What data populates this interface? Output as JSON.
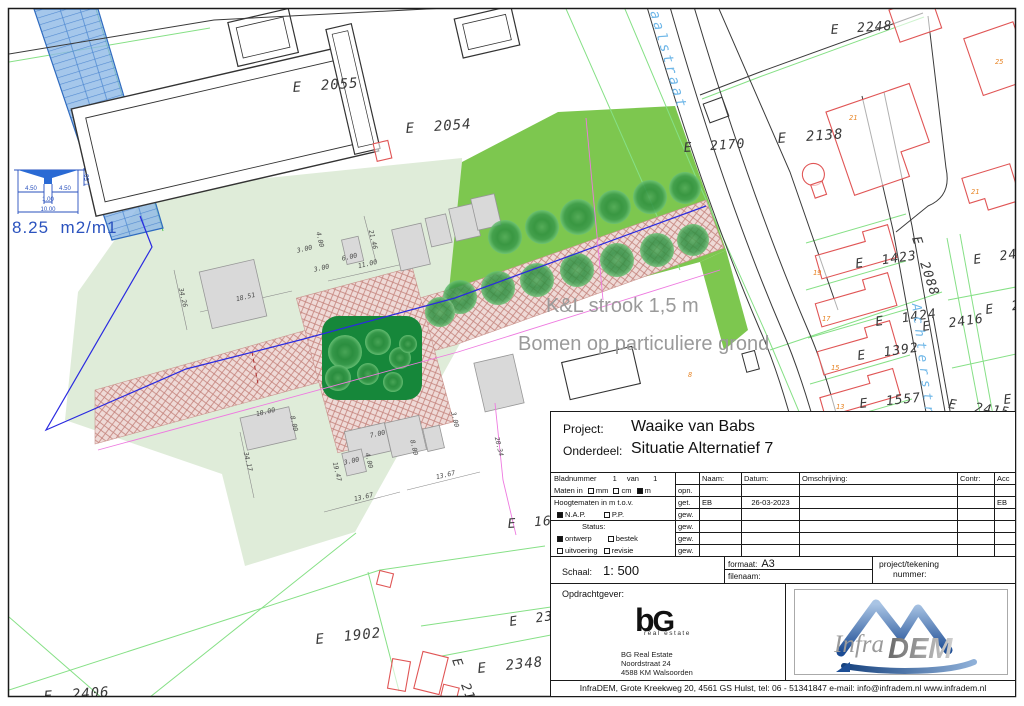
{
  "map": {
    "parcel_labels": [
      {
        "text": "E  2055",
        "x": 293,
        "y": 92,
        "size": 14,
        "rot": -4
      },
      {
        "text": "E  2054",
        "x": 406,
        "y": 133,
        "size": 14,
        "rot": -4
      },
      {
        "text": "E  2170",
        "x": 684,
        "y": 152,
        "size": 13,
        "rot": -4
      },
      {
        "text": "E  2138",
        "x": 778,
        "y": 143,
        "size": 14,
        "rot": -4
      },
      {
        "text": "E  2248",
        "x": 831,
        "y": 34,
        "size": 13,
        "rot": -4
      },
      {
        "text": "E  1423",
        "x": 856,
        "y": 268,
        "size": 13,
        "rot": -8
      },
      {
        "text": "E  2088",
        "x": 912,
        "y": 238,
        "size": 13,
        "rot": 72
      },
      {
        "text": "E  2417",
        "x": 974,
        "y": 264,
        "size": 13,
        "rot": -8
      },
      {
        "text": "E  241",
        "x": 986,
        "y": 314,
        "size": 13,
        "rot": -8
      },
      {
        "text": "E  1424",
        "x": 876,
        "y": 326,
        "size": 13,
        "rot": -8
      },
      {
        "text": "E  2416",
        "x": 923,
        "y": 331,
        "size": 13,
        "rot": -8
      },
      {
        "text": "E  1392",
        "x": 858,
        "y": 360,
        "size": 13,
        "rot": -8
      },
      {
        "text": "E  1557",
        "x": 860,
        "y": 408,
        "size": 13,
        "rot": -6
      },
      {
        "text": "E  2415",
        "x": 948,
        "y": 408,
        "size": 13,
        "rot": 8
      },
      {
        "text": "E",
        "x": 1004,
        "y": 404,
        "size": 13,
        "rot": -6
      },
      {
        "text": "E  160",
        "x": 508,
        "y": 528,
        "size": 13,
        "rot": -4
      },
      {
        "text": "E  2349",
        "x": 510,
        "y": 626,
        "size": 13,
        "rot": -8
      },
      {
        "text": "E  1902",
        "x": 316,
        "y": 644,
        "size": 14,
        "rot": -6
      },
      {
        "text": "E  2348",
        "x": 478,
        "y": 673,
        "size": 14,
        "rot": -6
      },
      {
        "text": "E  2172",
        "x": 452,
        "y": 660,
        "size": 13,
        "rot": 70
      },
      {
        "text": "E  2406",
        "x": 44,
        "y": 701,
        "size": 14,
        "rot": -4
      }
    ],
    "street_names": [
      {
        "text": "aalstraat",
        "x": 650,
        "y": 12,
        "rot": 74,
        "size": 14,
        "spacing": 3
      },
      {
        "text": "Achterstraat",
        "x": 912,
        "y": 304,
        "rot": 83,
        "size": 13,
        "spacing": 5
      }
    ],
    "annotations": [
      {
        "text": "K&L strook 1,5 m",
        "x": 546,
        "y": 312,
        "size": 20
      },
      {
        "text": "Bomen op particuliere grond",
        "x": 518,
        "y": 350,
        "size": 20
      }
    ],
    "house_numbers": [
      {
        "text": "25",
        "x": 995,
        "y": 64,
        "size": 7
      },
      {
        "text": "21",
        "x": 849,
        "y": 120,
        "size": 7
      },
      {
        "text": "21",
        "x": 971,
        "y": 194,
        "size": 7
      },
      {
        "text": "19",
        "x": 813,
        "y": 275,
        "size": 7
      },
      {
        "text": "17",
        "x": 822,
        "y": 321,
        "size": 7
      },
      {
        "text": "15",
        "x": 831,
        "y": 370,
        "size": 7
      },
      {
        "text": "13",
        "x": 836,
        "y": 409,
        "size": 7
      },
      {
        "text": "8",
        "x": 688,
        "y": 377,
        "size": 7
      }
    ],
    "dimensions": [
      {
        "text": "18.51",
        "x": 246,
        "y": 299,
        "rot": -13
      },
      {
        "text": "11.00",
        "x": 368,
        "y": 266,
        "rot": -13
      },
      {
        "text": "3.00",
        "x": 305,
        "y": 251,
        "rot": -13
      },
      {
        "text": "4.00",
        "x": 318,
        "y": 240,
        "rot": 77
      },
      {
        "text": "6.00",
        "x": 350,
        "y": 259,
        "rot": -13
      },
      {
        "text": "3.00",
        "x": 322,
        "y": 270,
        "rot": -13
      },
      {
        "text": "34.26",
        "x": 181,
        "y": 298,
        "rot": 77
      },
      {
        "text": "21.46",
        "x": 371,
        "y": 240,
        "rot": 77
      },
      {
        "text": "10.00",
        "x": 266,
        "y": 414,
        "rot": -13
      },
      {
        "text": "8.00",
        "x": 292,
        "y": 424,
        "rot": 77
      },
      {
        "text": "34.17",
        "x": 246,
        "y": 462,
        "rot": 77
      },
      {
        "text": "7.00",
        "x": 378,
        "y": 436,
        "rot": -13
      },
      {
        "text": "3.00",
        "x": 352,
        "y": 463,
        "rot": -13
      },
      {
        "text": "4.00",
        "x": 367,
        "y": 461,
        "rot": 77
      },
      {
        "text": "8.00",
        "x": 412,
        "y": 448,
        "rot": 77
      },
      {
        "text": "19.47",
        "x": 335,
        "y": 472,
        "rot": 77
      },
      {
        "text": "13.67",
        "x": 364,
        "y": 499,
        "rot": -13
      },
      {
        "text": "13.67",
        "x": 446,
        "y": 477,
        "rot": -13
      },
      {
        "text": "20.34",
        "x": 497,
        "y": 447,
        "rot": 77
      },
      {
        "text": "3.00",
        "x": 453,
        "y": 420,
        "rot": 77
      }
    ],
    "water": {
      "area_label": {
        "text": "8.25  m2/m1",
        "x": 12,
        "y": 233,
        "size": 17
      },
      "cross_section_dims": [
        {
          "text": "4.50",
          "x": 31,
          "y": 190
        },
        {
          "text": "4.50",
          "x": 65,
          "y": 190
        },
        {
          "text": "1.00",
          "x": 48,
          "y": 201
        },
        {
          "text": "10.00",
          "x": 48,
          "y": 211
        },
        {
          "text": "1.50",
          "x": 89,
          "y": 180,
          "rot": -90
        }
      ]
    }
  },
  "title_block": {
    "project_label": "Project:",
    "project": "Waaike van Babs",
    "onderdeel_label": "Onderdeel:",
    "onderdeel": "Situatie Alternatief 7",
    "bladnummer_label": "Bladnummer",
    "bladnummer": "1",
    "van_label": "van",
    "bladen_totaal": "1",
    "maten_label": "Maten in",
    "maten_options": [
      {
        "label": "mm",
        "checked": false
      },
      {
        "label": "cm",
        "checked": false
      },
      {
        "label": "m",
        "checked": true
      }
    ],
    "hoogtematen_label": "Hoogtematen in m t.o.v.",
    "hoogte_options": [
      {
        "label": "N.A.P.",
        "checked": true
      },
      {
        "label": "P.P.",
        "checked": false
      }
    ],
    "status_label": "Status:",
    "status_options": [
      {
        "label": "ontwerp",
        "checked": true
      },
      {
        "label": "bestek",
        "checked": false
      },
      {
        "label": "uitvoering",
        "checked": false
      },
      {
        "label": "revisie",
        "checked": false
      }
    ],
    "columns": {
      "naam": "Naam:",
      "datum": "Datum:",
      "omschrijving": "Omschrijving:",
      "contr": "Contr:",
      "acc": "Acc"
    },
    "revisions": [
      {
        "label": "opn.",
        "naam": "",
        "datum": "",
        "omschrijving": "",
        "contr": "",
        "acc": ""
      },
      {
        "label": "get.",
        "naam": "EB",
        "datum": "26-03-2023",
        "omschrijving": "",
        "contr": "",
        "acc": "EB"
      },
      {
        "label": "gew.",
        "naam": "",
        "datum": "",
        "omschrijving": "",
        "contr": "",
        "acc": ""
      },
      {
        "label": "gew.",
        "naam": "",
        "datum": "",
        "omschrijving": "",
        "contr": "",
        "acc": ""
      },
      {
        "label": "gew.",
        "naam": "",
        "datum": "",
        "omschrijving": "",
        "contr": "",
        "acc": ""
      },
      {
        "label": "gew.",
        "naam": "",
        "datum": "",
        "omschrijving": "",
        "contr": "",
        "acc": ""
      }
    ],
    "schaal_label": "Schaal:",
    "schaal": "1: 500",
    "formaat_label": "formaat:",
    "formaat": "A3",
    "filenaam_label": "filenaam:",
    "project_tekening_label": "project/tekening",
    "nummer_label": "nummer:",
    "opdrachtgever_label": "Opdrachtgever:",
    "client_logo": {
      "b": "b",
      "g": "G",
      "subtitle": "real estate"
    },
    "client_address": [
      "BG Real Estate",
      "Noordstraat 24",
      "4588 KM  Walsoorden"
    ],
    "infradem_logo": {
      "infra": "Infra",
      "dem": "DEM"
    }
  },
  "footer": "InfraDEM, Grote Kreekweg 20, 4561 GS Hulst, tel: 06 - 51341847  e-mail: info@infradem.nl   www.infradem.nl"
}
